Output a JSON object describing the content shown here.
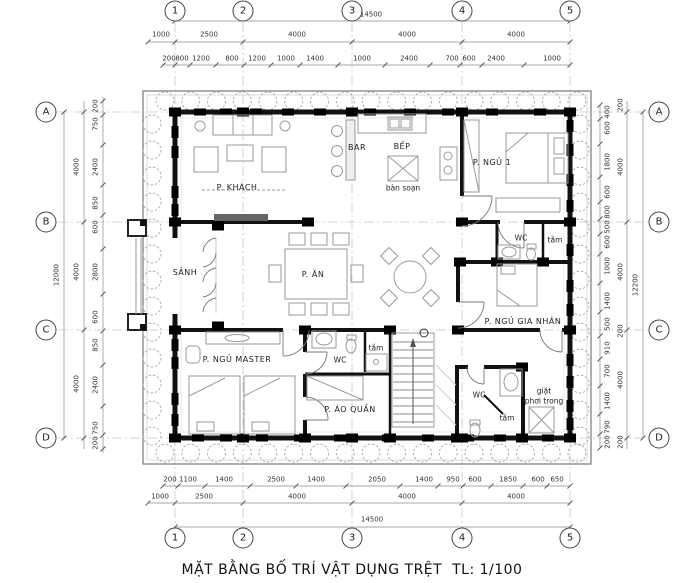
{
  "title": "MẶT BẰNG BỐ TRÍ VẬT DỤNG TRỆT  TL: 1/100",
  "axes": {
    "cols": [
      "1",
      "2",
      "3",
      "4",
      "5"
    ],
    "rows": [
      "A",
      "B",
      "C",
      "D"
    ]
  },
  "dims": {
    "top": {
      "overall": "14500",
      "major": [
        "1000",
        "2500",
        "4000",
        "4000",
        "4000"
      ],
      "minor": [
        "200",
        "800",
        "1200",
        "800",
        "1200",
        "1000",
        "1400",
        "1000",
        "2400",
        "700",
        "600",
        "2400",
        "1000"
      ]
    },
    "bottom": {
      "overall": "14500",
      "major": [
        "1000",
        "2500",
        "4000",
        "4000",
        "4000"
      ],
      "minor": [
        "200",
        "1100",
        "1400",
        "2500",
        "1400",
        "2050",
        "1400",
        "950",
        "600",
        "1850",
        "600",
        "650"
      ]
    },
    "left": {
      "overall": "12000",
      "major": [
        "4000",
        "4000",
        "4000"
      ],
      "minor": [
        "200",
        "750",
        "2400",
        "850",
        "600",
        "2800",
        "600",
        "850",
        "2400",
        "750",
        "200"
      ]
    },
    "right": {
      "overall": "12200",
      "major": [
        "4000",
        "4000",
        "4000"
      ],
      "minor": [
        "400",
        "600",
        "1800",
        "600",
        "800",
        "500",
        "600",
        "1000",
        "1400",
        "500",
        "910",
        "700",
        "1400",
        "790",
        "200"
      ],
      "offsets": [
        "200",
        "200",
        "200"
      ]
    }
  },
  "rooms": {
    "khach": "P. KHÁCH",
    "bar": "BAR",
    "bep": "BẾP",
    "ban_soan": "bàn soạn",
    "ngu1": "P. NGỦ 1",
    "wc_top": "WC",
    "tam_top": "tắm",
    "sanh": "SẢNH",
    "an": "P. ĂN",
    "ngu_gia_nhan": "P. NGỦ GIA NHÂN",
    "ngu_master": "P. NGỦ MASTER",
    "wc_master": "WC",
    "tam_master": "tắm",
    "ao_quan": "P. ÁO QUẦN",
    "wc_bottom": "WC",
    "tam_bottom": "tắm",
    "giat_line1": "giặt",
    "giat_line2": "phơi trong"
  }
}
